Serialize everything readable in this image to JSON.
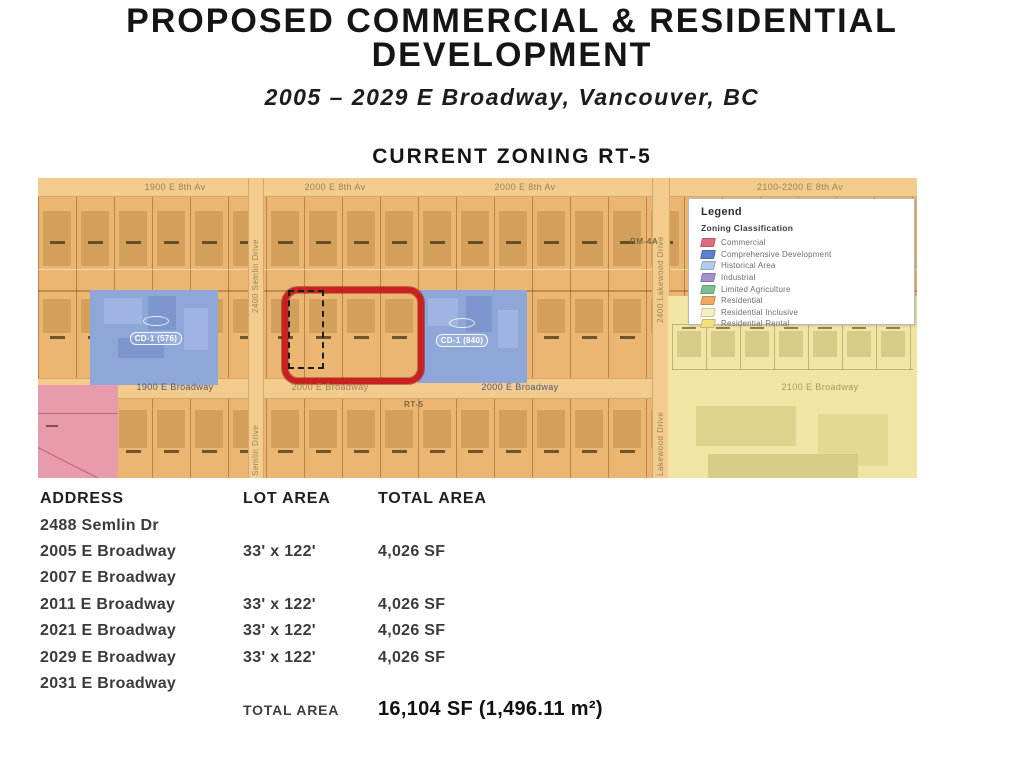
{
  "header": {
    "title_line1": "PROPOSED COMMERCIAL & RESIDENTIAL",
    "title_line2": "DEVELOPMENT",
    "subtitle": "2005 – 2029 E Broadway, Vancouver, BC",
    "map_heading": "CURRENT ZONING RT-5"
  },
  "map": {
    "streets": {
      "eighth": [
        "1900 E 8th Av",
        "2000 E 8th Av",
        "2000 E 8th Av",
        "2100-2200 E 8th Av"
      ],
      "broadway": [
        "1900 E Broadway",
        "2000 E Broadway",
        "2000 E Broadway",
        "2100 E Broadway"
      ],
      "semlin_upper": "2400 Semlin Drive",
      "semlin_lower": "Semlin Drive",
      "lakewood_upper": "2400 Lakewood Drive",
      "lakewood_lower": "Lakewood Drive"
    },
    "zone_labels": {
      "rt5": "RT-5",
      "rm4a": "RM-4A",
      "cd_left": "CD-1 (576)",
      "cd_right": "CD-1 (840)"
    },
    "colors": {
      "base_tan": "#EAB671",
      "street": "#F3CB8C",
      "cd_blue": "#8FA6D9",
      "commercial_pink": "#E79BAB",
      "residential_yellow": "#F1E4A4",
      "highlight_red": "#C92020"
    }
  },
  "legend": {
    "title": "Legend",
    "subtitle": "Zoning Classification",
    "items": [
      {
        "label": "Commercial",
        "color": "#E2697E"
      },
      {
        "label": "Comprehensive Development",
        "color": "#5C7FD0"
      },
      {
        "label": "Historical Area",
        "color": "#AFCBE8"
      },
      {
        "label": "Industrial",
        "color": "#A291CE"
      },
      {
        "label": "Limited Agriculture",
        "color": "#7CC08F"
      },
      {
        "label": "Residential",
        "color": "#EFA963"
      },
      {
        "label": "Residential Inclusive",
        "color": "#F7EFC0"
      },
      {
        "label": "Residential Rental",
        "color": "#F2DF7E"
      }
    ]
  },
  "table": {
    "headers": [
      "ADDRESS",
      "LOT AREA",
      "TOTAL AREA"
    ],
    "rows": [
      {
        "address": "2488 Semlin Dr",
        "lot_area": "",
        "total_area": ""
      },
      {
        "address": "2005 E Broadway",
        "lot_area": "33' x 122'",
        "total_area": "4,026 SF"
      },
      {
        "address": "2007 E Broadway",
        "lot_area": "",
        "total_area": ""
      },
      {
        "address": "2011 E Broadway",
        "lot_area": "33' x 122'",
        "total_area": "4,026 SF"
      },
      {
        "address": "2021 E Broadway",
        "lot_area": "33' x 122'",
        "total_area": "4,026 SF"
      },
      {
        "address": "2029 E Broadway",
        "lot_area": "33' x 122'",
        "total_area": "4,026 SF"
      },
      {
        "address": "2031 E Broadway",
        "lot_area": "",
        "total_area": ""
      }
    ],
    "total_label": "TOTAL AREA",
    "total_value": "16,104 SF (1,496.11 m²)"
  }
}
